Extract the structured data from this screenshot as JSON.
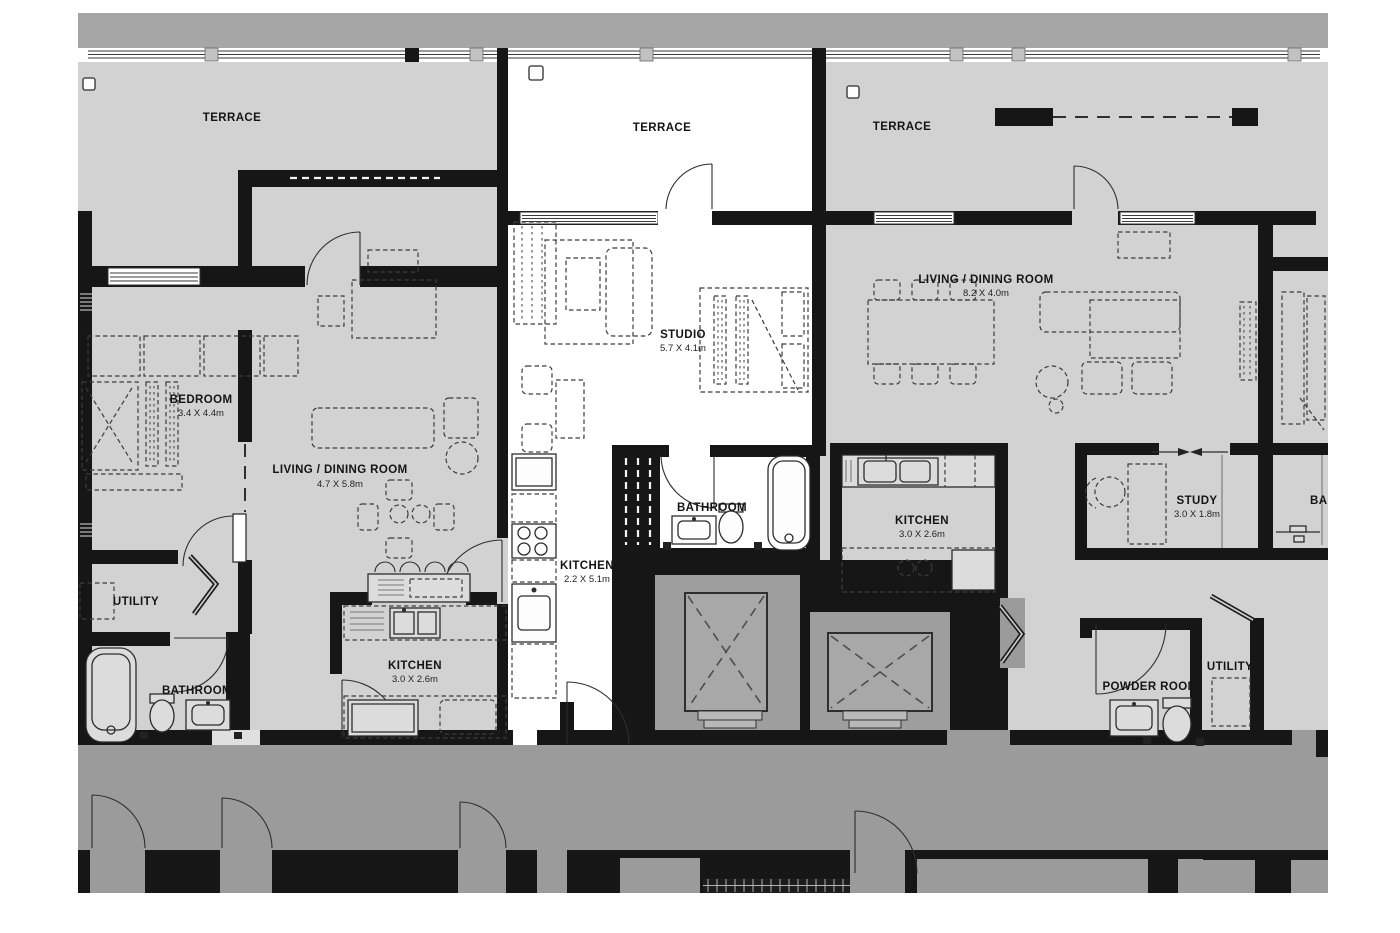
{
  "plan": {
    "type": "apartment-floor-plan",
    "palette": {
      "room_gray": "#d2d2d2",
      "corridor_gray": "#9b9b9b",
      "top_band_gray": "#a6a6a6",
      "wall_black": "#161616",
      "elevator_shaft_gray": "#9e9e9e",
      "elevator_cab_gray": "#a8a8a8",
      "studio_white": "#ffffff"
    },
    "rooms": {
      "terrace_left": {
        "label": "TERRACE"
      },
      "terrace_center": {
        "label": "TERRACE"
      },
      "terrace_right": {
        "label": "TERRACE"
      },
      "bedroom": {
        "label": "BEDROOM",
        "dims": "3.4 X 4.4m"
      },
      "living_left": {
        "label": "LIVING / DINING ROOM",
        "dims": "4.7 X 5.8m"
      },
      "studio": {
        "label": "STUDIO",
        "dims": "5.7 X 4.1m"
      },
      "living_right": {
        "label": "LIVING / DINING ROOM",
        "dims": "8.2 X 4.0m"
      },
      "bathroom_studio": {
        "label": "BATHROOM"
      },
      "kitchen_studio": {
        "label": "KITCHEN",
        "dims": "2.2 X 5.1m"
      },
      "kitchen_right": {
        "label": "KITCHEN",
        "dims": "3.0 X 2.6m"
      },
      "study": {
        "label": "STUDY",
        "dims": "3.0 X 1.8m"
      },
      "utility_left": {
        "label": "UTILITY"
      },
      "bathroom_left": {
        "label": "BATHROOM"
      },
      "kitchen_left": {
        "label": "KITCHEN",
        "dims": "3.0 X 2.6m"
      },
      "powder_room": {
        "label": "POWDER ROOM"
      },
      "utility_right": {
        "label": "UTILITY"
      },
      "bathroom_right_cropped": {
        "label": "BA"
      }
    }
  }
}
